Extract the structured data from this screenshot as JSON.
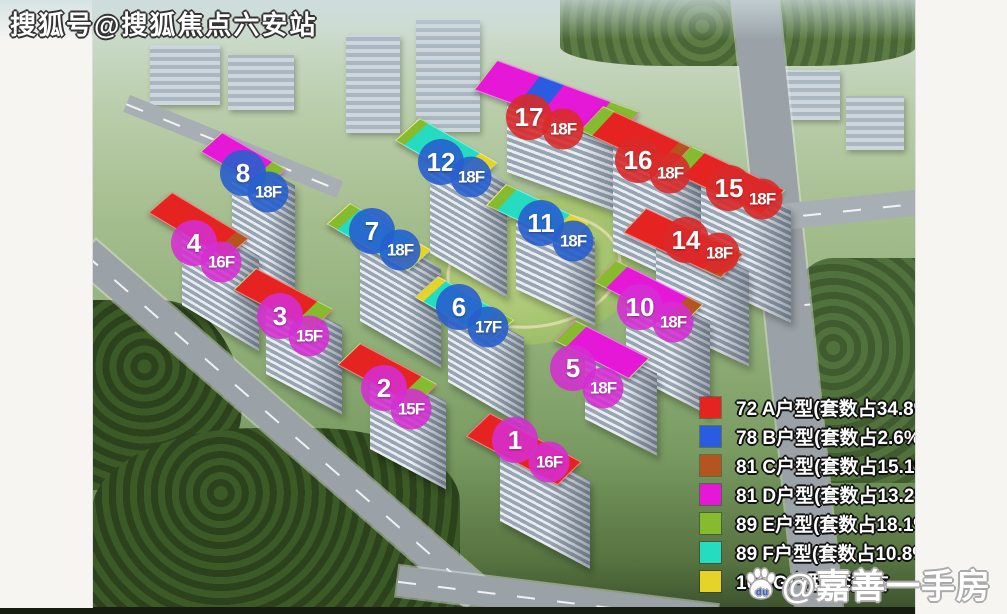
{
  "watermarks": {
    "top_left": "搜狐号@搜狐焦点六安站",
    "bottom_right": "@嘉善一手房",
    "bottom_right_icon_text": "du"
  },
  "legend": {
    "items": [
      {
        "color_key": "red",
        "color": "#e52421",
        "label": "72 A户型(套数占34.8%)"
      },
      {
        "color_key": "blue",
        "color": "#2a5be0",
        "label": "78 B户型(套数占2.6%)"
      },
      {
        "color_key": "orange",
        "color": "#b5541f",
        "label": "81 C户型(套数占15.1%)"
      },
      {
        "color_key": "magenta",
        "color": "#e618d8",
        "label": "81 D户型(套数占13.2%)"
      },
      {
        "color_key": "green",
        "color": "#86ba2f",
        "label": "89 E户型(套数占18.1%)"
      },
      {
        "color_key": "cyan",
        "color": "#26dcc0",
        "label": "89 F户型(套数占10.8%)"
      },
      {
        "color_key": "yellow",
        "color": "#e6d32a",
        "label": "103 G户型(套数占"
      }
    ]
  },
  "palette": {
    "red": "#e52421",
    "blue": "#2a5be0",
    "orange": "#b5541f",
    "magenta": "#e618d8",
    "green": "#86ba2f",
    "cyan": "#26dcc0",
    "yellow": "#e6d32a",
    "badge_magenta": "rgba(213,45,210,0.88)",
    "badge_blue": "rgba(40,95,205,0.9)",
    "badge_red": "rgba(217,42,42,0.9)"
  },
  "buildings": [
    {
      "num": "17",
      "floor": "18F",
      "badge": "red",
      "nx": 529,
      "ny": 117,
      "fx": 563,
      "fy": 129,
      "roof": {
        "x": 497,
        "y": 60,
        "len": 150,
        "h": 34,
        "angle": 20
      },
      "body": 90,
      "segments": [
        {
          "c": "magenta",
          "f": 0.3
        },
        {
          "c": "blue",
          "f": 0.17
        },
        {
          "c": "magenta",
          "f": 0.33
        },
        {
          "c": "green",
          "f": 0.2
        }
      ]
    },
    {
      "num": "8",
      "floor": "18F",
      "badge": "blue",
      "nx": 243,
      "ny": 173,
      "fx": 268,
      "fy": 192,
      "roof": {
        "x": 222,
        "y": 132,
        "len": 72,
        "h": 26,
        "angle": 30
      },
      "body": 105,
      "segments": [
        {
          "c": "magenta",
          "f": 0.8
        },
        {
          "c": "green",
          "f": 0.2
        }
      ]
    },
    {
      "num": "12",
      "floor": "18F",
      "badge": "blue",
      "nx": 441,
      "ny": 162,
      "fx": 471,
      "fy": 177,
      "roof": {
        "x": 420,
        "y": 118,
        "len": 88,
        "h": 30,
        "angle": 30
      },
      "body": 115,
      "segments": [
        {
          "c": "green",
          "f": 0.1
        },
        {
          "c": "cyan",
          "f": 0.68
        },
        {
          "c": "yellow",
          "f": 0.22
        }
      ]
    },
    {
      "num": "16",
      "floor": "18F",
      "badge": "red",
      "nx": 638,
      "ny": 160,
      "fx": 670,
      "fy": 173,
      "roof": {
        "x": 603,
        "y": 106,
        "len": 102,
        "h": 30,
        "angle": 25
      },
      "body": 125,
      "segments": [
        {
          "c": "green",
          "f": 0.12
        },
        {
          "c": "red",
          "f": 0.7
        },
        {
          "c": "orange",
          "f": 0.18
        }
      ]
    },
    {
      "num": "15",
      "floor": "18F",
      "badge": "red",
      "nx": 729,
      "ny": 188,
      "fx": 762,
      "fy": 199,
      "roof": {
        "x": 691,
        "y": 146,
        "len": 102,
        "h": 30,
        "angle": 25
      },
      "body": 115,
      "segments": [
        {
          "c": "green",
          "f": 0.14
        },
        {
          "c": "red",
          "f": 0.86
        }
      ]
    },
    {
      "num": "11",
      "floor": "18F",
      "badge": "blue",
      "nx": 541,
      "ny": 223,
      "fx": 573,
      "fy": 241,
      "roof": {
        "x": 506,
        "y": 184,
        "len": 90,
        "h": 26,
        "angle": 25
      },
      "body": 88,
      "segments": [
        {
          "c": "green",
          "f": 0.12
        },
        {
          "c": "cyan",
          "f": 0.66
        },
        {
          "c": "yellow",
          "f": 0.22
        }
      ]
    },
    {
      "num": "14",
      "floor": "18F",
      "badge": "red",
      "nx": 686,
      "ny": 240,
      "fx": 719,
      "fy": 253,
      "roof": {
        "x": 646,
        "y": 208,
        "len": 106,
        "h": 30,
        "angle": 25
      },
      "body": 95,
      "segments": [
        {
          "c": "red",
          "f": 0.82
        },
        {
          "c": "orange",
          "f": 0.18
        }
      ]
    },
    {
      "num": "10",
      "floor": "18F",
      "badge": "magenta",
      "nx": 640,
      "ny": 307,
      "fx": 673,
      "fy": 322,
      "roof": {
        "x": 616,
        "y": 260,
        "len": 96,
        "h": 28,
        "angle": 27
      },
      "body": 95,
      "segments": [
        {
          "c": "green",
          "f": 0.13
        },
        {
          "c": "magenta",
          "f": 0.7
        },
        {
          "c": "orange",
          "f": 0.17
        }
      ]
    },
    {
      "num": "7",
      "floor": "18F",
      "badge": "blue",
      "nx": 372,
      "ny": 231,
      "fx": 400,
      "fy": 250,
      "roof": {
        "x": 350,
        "y": 203,
        "len": 92,
        "h": 28,
        "angle": 30
      },
      "body": 100,
      "segments": [
        {
          "c": "green",
          "f": 0.12
        },
        {
          "c": "cyan",
          "f": 0.64
        },
        {
          "c": "yellow",
          "f": 0.24
        }
      ]
    },
    {
      "num": "4",
      "floor": "16F",
      "badge": "magenta",
      "nx": 194,
      "ny": 243,
      "fx": 221,
      "fy": 262,
      "roof": {
        "x": 172,
        "y": 192,
        "len": 88,
        "h": 28,
        "angle": 31
      },
      "body": 95,
      "segments": [
        {
          "c": "red",
          "f": 0.85
        },
        {
          "c": "orange",
          "f": 0.15
        }
      ]
    },
    {
      "num": "6",
      "floor": "17F",
      "badge": "blue",
      "nx": 459,
      "ny": 307,
      "fx": 488,
      "fy": 327,
      "roof": {
        "x": 438,
        "y": 276,
        "len": 86,
        "h": 28,
        "angle": 30
      },
      "body": 88,
      "segments": [
        {
          "c": "yellow",
          "f": 0.1
        },
        {
          "c": "cyan",
          "f": 0.68
        },
        {
          "c": "green",
          "f": 0.22
        }
      ]
    },
    {
      "num": "5",
      "floor": "18F",
      "badge": "magenta",
      "nx": 573,
      "ny": 368,
      "fx": 603,
      "fy": 388,
      "roof": {
        "x": 575,
        "y": 320,
        "len": 82,
        "h": 26,
        "angle": 27
      },
      "body": 82,
      "segments": [
        {
          "c": "green",
          "f": 0.15
        },
        {
          "c": "magenta",
          "f": 0.85
        }
      ]
    },
    {
      "num": "3",
      "floor": "15F",
      "badge": "magenta",
      "nx": 280,
      "ny": 316,
      "fx": 309,
      "fy": 336,
      "roof": {
        "x": 256,
        "y": 268,
        "len": 86,
        "h": 28,
        "angle": 28
      },
      "body": 88,
      "segments": [
        {
          "c": "red",
          "f": 0.8
        },
        {
          "c": "green",
          "f": 0.2
        }
      ]
    },
    {
      "num": "2",
      "floor": "15F",
      "badge": "magenta",
      "nx": 384,
      "ny": 388,
      "fx": 411,
      "fy": 409,
      "roof": {
        "x": 360,
        "y": 343,
        "len": 86,
        "h": 28,
        "angle": 28
      },
      "body": 88,
      "segments": [
        {
          "c": "red",
          "f": 0.8
        },
        {
          "c": "green",
          "f": 0.2
        }
      ]
    },
    {
      "num": "1",
      "floor": "16F",
      "badge": "magenta",
      "nx": 515,
      "ny": 440,
      "fx": 549,
      "fy": 462,
      "roof": {
        "x": 490,
        "y": 413,
        "len": 102,
        "h": 30,
        "angle": 28
      },
      "body": 88,
      "segments": [
        {
          "c": "red",
          "f": 1.0
        }
      ]
    }
  ]
}
